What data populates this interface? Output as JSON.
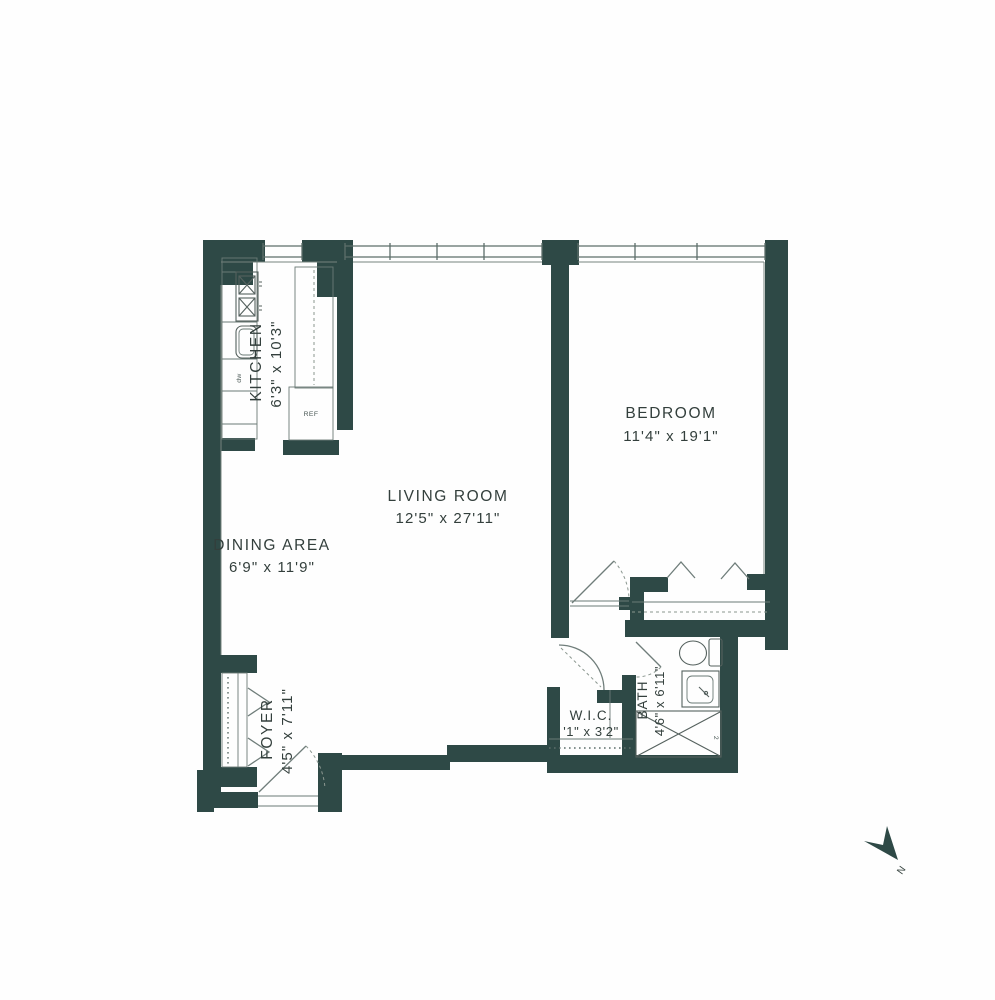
{
  "plan": {
    "title": "apartment-floor-plan",
    "rooms": [
      {
        "name": "KITCHEN",
        "dims": "6'3\" x 10'3\""
      },
      {
        "name": "LIVING ROOM",
        "dims": "12'5\" x 27'11\""
      },
      {
        "name": "DINING AREA",
        "dims": "6'9\" x 11'9\""
      },
      {
        "name": "BEDROOM",
        "dims": "11'4\" x 19'1\""
      },
      {
        "name": "FOYER",
        "dims": "4'5\" x 7'11\""
      },
      {
        "name": "W.I.C.",
        "dims": "'1\" x 3'2\""
      },
      {
        "name": "BATH",
        "dims": "4'6\" x 6'11\""
      }
    ],
    "labels": {
      "refrigerator": "REF",
      "dishwasher": "dw",
      "tub_fixture": "2",
      "compass_north": "N"
    },
    "colors": {
      "wall": "#2e4946",
      "thin_line": "#6b7a76",
      "text": "#333f3c",
      "background": "#fefefe"
    }
  }
}
